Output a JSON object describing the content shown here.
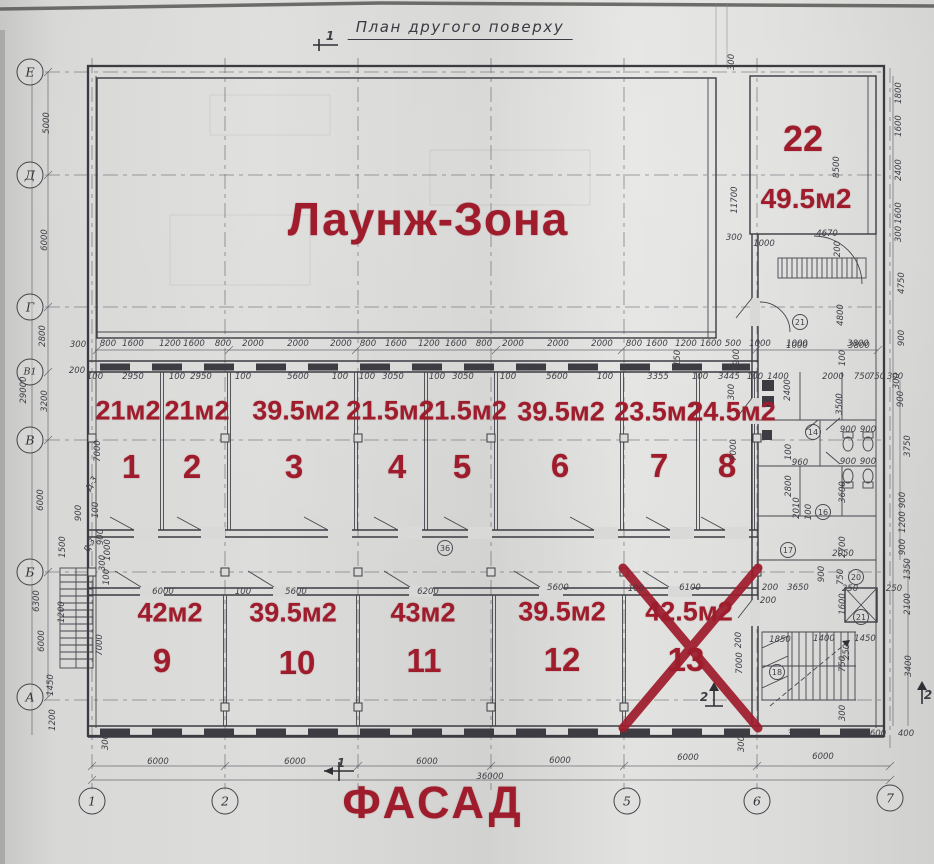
{
  "colors": {
    "annotation_red": "#9e1c2b",
    "ink": "#3b3b42",
    "paper": "#d9d9d7"
  },
  "header": {
    "title": "План другого поверху"
  },
  "labels": {
    "lounge": "Лаунж-Зона",
    "facade": "ФАСАД"
  },
  "crossed_room": "13",
  "rooms": [
    {
      "number": "1",
      "area": "21м2"
    },
    {
      "number": "2",
      "area": "21м2"
    },
    {
      "number": "3",
      "area": "39.5м2"
    },
    {
      "number": "4",
      "area": "21.5м2"
    },
    {
      "number": "5",
      "area": "21.5м2"
    },
    {
      "number": "6",
      "area": "39.5м2"
    },
    {
      "number": "7",
      "area": "23.5м2"
    },
    {
      "number": "8",
      "area": "24.5м2"
    },
    {
      "number": "9",
      "area": "42м2"
    },
    {
      "number": "10",
      "area": "39.5м2"
    },
    {
      "number": "11",
      "area": "43м2"
    },
    {
      "number": "12",
      "area": "39.5м2"
    },
    {
      "number": "13",
      "area": "42.5м2",
      "crossed_out": true
    },
    {
      "number": "22",
      "area": "49.5м2"
    }
  ],
  "axes": {
    "rows": [
      "Е",
      "Д",
      "Г",
      "В1",
      "В",
      "Б",
      "А"
    ],
    "cols": [
      "1",
      "2",
      "5",
      "6",
      "7"
    ]
  },
  "dimensions": [
    {
      "t": "5000",
      "x": 47,
      "y": 123,
      "r": -90
    },
    {
      "t": "6000",
      "x": 45,
      "y": 240,
      "r": -90
    },
    {
      "t": "2800",
      "x": 43,
      "y": 336,
      "r": -90
    },
    {
      "t": "29000",
      "x": 24,
      "y": 390,
      "r": -90
    },
    {
      "t": "3200",
      "x": 45,
      "y": 401,
      "r": -90
    },
    {
      "t": "300",
      "x": 78,
      "y": 345
    },
    {
      "t": "200",
      "x": 77,
      "y": 371
    },
    {
      "t": "6000",
      "x": 41,
      "y": 500,
      "r": -90
    },
    {
      "t": "900",
      "x": 79,
      "y": 513,
      "r": -90
    },
    {
      "t": "1500",
      "x": 63,
      "y": 547,
      "r": -90
    },
    {
      "t": "6300",
      "x": 37,
      "y": 601,
      "r": -90
    },
    {
      "t": "1200",
      "x": 62,
      "y": 612,
      "r": -90
    },
    {
      "t": "6000",
      "x": 42,
      "y": 641,
      "r": -90
    },
    {
      "t": "7000",
      "x": 100,
      "y": 645,
      "r": -90
    },
    {
      "t": "1450",
      "x": 51,
      "y": 685,
      "r": -90
    },
    {
      "t": "1200",
      "x": 53,
      "y": 720,
      "r": -90
    },
    {
      "t": "300",
      "x": 106,
      "y": 742,
      "r": -90
    },
    {
      "t": "7000",
      "x": 98,
      "y": 451,
      "r": -90
    },
    {
      "t": "100",
      "x": 96,
      "y": 510,
      "r": -90
    },
    {
      "t": "800",
      "x": 108,
      "y": 344
    },
    {
      "t": "1600",
      "x": 133,
      "y": 344
    },
    {
      "t": "1200",
      "x": 170,
      "y": 344
    },
    {
      "t": "1600",
      "x": 194,
      "y": 344
    },
    {
      "t": "800",
      "x": 223,
      "y": 344
    },
    {
      "t": "2000",
      "x": 253,
      "y": 344
    },
    {
      "t": "2000",
      "x": 298,
      "y": 344
    },
    {
      "t": "2000",
      "x": 341,
      "y": 344
    },
    {
      "t": "800",
      "x": 368,
      "y": 344
    },
    {
      "t": "1600",
      "x": 396,
      "y": 344
    },
    {
      "t": "1200",
      "x": 429,
      "y": 344
    },
    {
      "t": "1600",
      "x": 456,
      "y": 344
    },
    {
      "t": "800",
      "x": 484,
      "y": 344
    },
    {
      "t": "2000",
      "x": 513,
      "y": 344
    },
    {
      "t": "2000",
      "x": 558,
      "y": 344
    },
    {
      "t": "2000",
      "x": 602,
      "y": 344
    },
    {
      "t": "800",
      "x": 634,
      "y": 344
    },
    {
      "t": "1600",
      "x": 657,
      "y": 344
    },
    {
      "t": "1200",
      "x": 686,
      "y": 344
    },
    {
      "t": "1600",
      "x": 711,
      "y": 344
    },
    {
      "t": "500",
      "x": 733,
      "y": 344
    },
    {
      "t": "1000",
      "x": 760,
      "y": 344
    },
    {
      "t": "1000",
      "x": 797,
      "y": 344
    },
    {
      "t": "3800",
      "x": 858,
      "y": 344
    },
    {
      "t": "100",
      "x": 95,
      "y": 377
    },
    {
      "t": "2950",
      "x": 133,
      "y": 377
    },
    {
      "t": "100",
      "x": 177,
      "y": 377
    },
    {
      "t": "2950",
      "x": 201,
      "y": 377
    },
    {
      "t": "100",
      "x": 243,
      "y": 377
    },
    {
      "t": "5600",
      "x": 298,
      "y": 377
    },
    {
      "t": "100",
      "x": 340,
      "y": 377
    },
    {
      "t": "100",
      "x": 367,
      "y": 377
    },
    {
      "t": "3050",
      "x": 393,
      "y": 377
    },
    {
      "t": "100",
      "x": 437,
      "y": 377
    },
    {
      "t": "3050",
      "x": 463,
      "y": 377
    },
    {
      "t": "100",
      "x": 508,
      "y": 377
    },
    {
      "t": "5600",
      "x": 557,
      "y": 377
    },
    {
      "t": "100",
      "x": 605,
      "y": 377
    },
    {
      "t": "3355",
      "x": 658,
      "y": 377
    },
    {
      "t": "100",
      "x": 700,
      "y": 377
    },
    {
      "t": "3445",
      "x": 729,
      "y": 377
    },
    {
      "t": "100",
      "x": 755,
      "y": 377
    },
    {
      "t": "1400",
      "x": 778,
      "y": 377
    },
    {
      "t": "2000",
      "x": 833,
      "y": 377
    },
    {
      "t": "750",
      "x": 862,
      "y": 377
    },
    {
      "t": "750",
      "x": 877,
      "y": 377
    },
    {
      "t": "300",
      "x": 895,
      "y": 377
    },
    {
      "t": "150",
      "x": 678,
      "y": 358,
      "r": -90
    },
    {
      "t": "900",
      "x": 737,
      "y": 357,
      "r": -90
    },
    {
      "t": "100",
      "x": 843,
      "y": 358,
      "r": -90
    },
    {
      "t": "300",
      "x": 732,
      "y": 62,
      "r": -90
    },
    {
      "t": "11700",
      "x": 735,
      "y": 200,
      "r": -90
    },
    {
      "t": "8500",
      "x": 837,
      "y": 167,
      "r": -90
    },
    {
      "t": "1800",
      "x": 899,
      "y": 93,
      "r": -90
    },
    {
      "t": "1600",
      "x": 899,
      "y": 126,
      "r": -90
    },
    {
      "t": "2400",
      "x": 899,
      "y": 170,
      "r": -90
    },
    {
      "t": "1600",
      "x": 899,
      "y": 213,
      "r": -90
    },
    {
      "t": "300",
      "x": 899,
      "y": 234,
      "r": -90
    },
    {
      "t": "4750",
      "x": 902,
      "y": 283,
      "r": -90
    },
    {
      "t": "4670",
      "x": 827,
      "y": 234
    },
    {
      "t": "300",
      "x": 734,
      "y": 238
    },
    {
      "t": "1000",
      "x": 764,
      "y": 244
    },
    {
      "t": "200",
      "x": 838,
      "y": 249,
      "r": -90
    },
    {
      "t": "4800",
      "x": 841,
      "y": 315,
      "r": -90
    },
    {
      "t": "1000",
      "x": 797,
      "y": 346
    },
    {
      "t": "3800",
      "x": 859,
      "y": 346
    },
    {
      "t": "900",
      "x": 902,
      "y": 338,
      "r": -90
    },
    {
      "t": "300",
      "x": 732,
      "y": 392,
      "r": -90
    },
    {
      "t": "7000",
      "x": 734,
      "y": 450,
      "r": -90
    },
    {
      "t": "300",
      "x": 897,
      "y": 381,
      "r": -90
    },
    {
      "t": "900",
      "x": 901,
      "y": 399,
      "r": -90
    },
    {
      "t": "3750",
      "x": 908,
      "y": 446,
      "r": -90
    },
    {
      "t": "900",
      "x": 903,
      "y": 500,
      "r": -90
    },
    {
      "t": "1200",
      "x": 903,
      "y": 522,
      "r": -90
    },
    {
      "t": "900",
      "x": 903,
      "y": 547,
      "r": -90
    },
    {
      "t": "1350",
      "x": 908,
      "y": 569,
      "r": -90
    },
    {
      "t": "2400",
      "x": 788,
      "y": 390,
      "r": -90
    },
    {
      "t": "3500",
      "x": 840,
      "y": 404,
      "r": -90
    },
    {
      "t": "900",
      "x": 848,
      "y": 430
    },
    {
      "t": "900",
      "x": 868,
      "y": 430
    },
    {
      "t": "900",
      "x": 848,
      "y": 462
    },
    {
      "t": "900",
      "x": 868,
      "y": 462
    },
    {
      "t": "960",
      "x": 800,
      "y": 463
    },
    {
      "t": "100",
      "x": 789,
      "y": 452,
      "r": -90
    },
    {
      "t": "2800",
      "x": 789,
      "y": 486,
      "r": -90
    },
    {
      "t": "3600",
      "x": 843,
      "y": 492,
      "r": -90
    },
    {
      "t": "2010",
      "x": 797,
      "y": 508,
      "r": -90
    },
    {
      "t": "100",
      "x": 809,
      "y": 512,
      "r": -90
    },
    {
      "t": "2700",
      "x": 843,
      "y": 547,
      "r": -90
    },
    {
      "t": "2050",
      "x": 843,
      "y": 554
    },
    {
      "t": "200",
      "x": 770,
      "y": 588
    },
    {
      "t": "3650",
      "x": 798,
      "y": 588
    },
    {
      "t": "900",
      "x": 822,
      "y": 574,
      "r": -90
    },
    {
      "t": "750",
      "x": 841,
      "y": 577,
      "r": -90
    },
    {
      "t": "250",
      "x": 850,
      "y": 589
    },
    {
      "t": "250",
      "x": 894,
      "y": 589
    },
    {
      "t": "2100",
      "x": 908,
      "y": 604,
      "r": -90
    },
    {
      "t": "1600",
      "x": 843,
      "y": 604,
      "r": -90
    },
    {
      "t": "1850",
      "x": 780,
      "y": 640
    },
    {
      "t": "1400",
      "x": 824,
      "y": 639
    },
    {
      "t": "1450",
      "x": 865,
      "y": 639
    },
    {
      "t": "250",
      "x": 847,
      "y": 652,
      "r": -90
    },
    {
      "t": "3400",
      "x": 909,
      "y": 666,
      "r": -90
    },
    {
      "t": "750",
      "x": 843,
      "y": 664,
      "r": -90
    },
    {
      "t": "300",
      "x": 843,
      "y": 713,
      "r": -90
    },
    {
      "t": "3400",
      "x": 798,
      "y": 734
    },
    {
      "t": "1600",
      "x": 851,
      "y": 734
    },
    {
      "t": "600",
      "x": 878,
      "y": 734
    },
    {
      "t": "400",
      "x": 906,
      "y": 734
    },
    {
      "t": "6000",
      "x": 823,
      "y": 757
    },
    {
      "t": "300",
      "x": 742,
      "y": 744,
      "r": -90
    },
    {
      "t": "7000",
      "x": 740,
      "y": 663,
      "r": -90
    },
    {
      "t": "200",
      "x": 739,
      "y": 640,
      "r": -90
    },
    {
      "t": "900",
      "x": 101,
      "y": 537,
      "r": -90
    },
    {
      "t": "1000",
      "x": 108,
      "y": 550,
      "r": -90
    },
    {
      "t": "300",
      "x": 103,
      "y": 563,
      "r": -90
    },
    {
      "t": "100",
      "x": 107,
      "y": 577,
      "r": -90
    },
    {
      "t": "6000",
      "x": 163,
      "y": 592
    },
    {
      "t": "100",
      "x": 243,
      "y": 592
    },
    {
      "t": "5600",
      "x": 296,
      "y": 592
    },
    {
      "t": "6200",
      "x": 428,
      "y": 592
    },
    {
      "t": "5600",
      "x": 558,
      "y": 588
    },
    {
      "t": "100",
      "x": 636,
      "y": 589
    },
    {
      "t": "6100",
      "x": 690,
      "y": 588
    },
    {
      "t": "200",
      "x": 768,
      "y": 601
    },
    {
      "t": "6000",
      "x": 158,
      "y": 762
    },
    {
      "t": "6000",
      "x": 295,
      "y": 762
    },
    {
      "t": "6000",
      "x": 427,
      "y": 762
    },
    {
      "t": "6000",
      "x": 560,
      "y": 761
    },
    {
      "t": "6000",
      "x": 688,
      "y": 758
    },
    {
      "t": "36000",
      "x": 490,
      "y": 777
    },
    {
      "t": "36",
      "x": 445,
      "y": 548,
      "c": 1
    },
    {
      "t": "14",
      "x": 813,
      "y": 432,
      "c": 1
    },
    {
      "t": "16",
      "x": 823,
      "y": 512,
      "c": 1
    },
    {
      "t": "17",
      "x": 788,
      "y": 550,
      "c": 1
    },
    {
      "t": "18",
      "x": 777,
      "y": 672,
      "c": 1
    },
    {
      "t": "20",
      "x": 856,
      "y": 577,
      "c": 1
    },
    {
      "t": "21",
      "x": 800,
      "y": 322,
      "c": 1
    },
    {
      "t": "21",
      "x": 861,
      "y": 617,
      "c": 1
    },
    {
      "t": "Д-3",
      "x": 90,
      "y": 546,
      "r": -60
    },
    {
      "t": "Д-3",
      "x": 92,
      "y": 484,
      "r": -60
    },
    {
      "t": "1",
      "x": 330,
      "y": 36,
      "s": 1
    },
    {
      "t": "1",
      "x": 341,
      "y": 763,
      "s": 1
    },
    {
      "t": "2",
      "x": 704,
      "y": 697,
      "s": 1
    },
    {
      "t": "2",
      "x": 928,
      "y": 695,
      "s": 1
    }
  ]
}
